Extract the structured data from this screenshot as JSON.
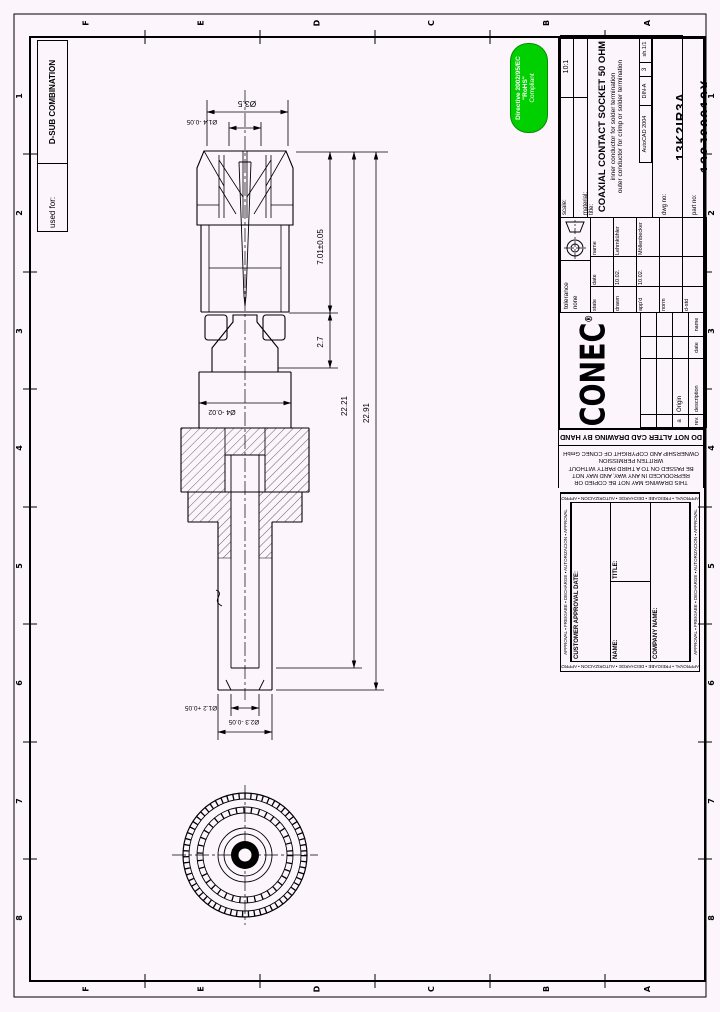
{
  "sheet": {
    "used_for_label": "used for:",
    "used_for_value": "D-SUB COMBINATION",
    "zone_letters": [
      "F",
      "E",
      "D",
      "C",
      "B",
      "A"
    ],
    "zone_numbers": [
      "1",
      "2",
      "3",
      "4",
      "5",
      "6",
      "7",
      "8"
    ],
    "line_color": "#000000",
    "paper_color": "#fdf5fc"
  },
  "rohs": {
    "line1": "Directive 2002/95/EC",
    "line2": "\"RoHS\"",
    "line3": "Compliant",
    "badge_color": "#00cf00"
  },
  "title_block": {
    "scale_label": "scale:",
    "scale_value": "10:1",
    "material_label": "material:",
    "material_value": "",
    "title_label": "title:",
    "title": "COAXIAL CONTACT SOCKET 50 OHM",
    "subtitle1": "inner conductor for solder termination",
    "subtitle2": "outer conductor for crimp or solder termination",
    "cad_system": "AutoCAD 2004",
    "format": "DIN-A",
    "format_size": "3",
    "sheet_no": "sh.1/1",
    "dwg_no_label": "dwg no:",
    "dwg_no": "13K2IR3A",
    "part_no_label": "part no:",
    "part_no": "132J20019X",
    "company": "CONEC",
    "registered_mark": "®",
    "tolerance_label": "tolerance",
    "tolerance_value": "none",
    "sign_table": {
      "headers": [
        "state",
        "date",
        "name"
      ],
      "rows": [
        {
          "label": "drawn",
          "date": "10.02.",
          "name": "Lehmkühler"
        },
        {
          "label": "app'd",
          "date": "10.02.",
          "name": "Möllenbecker"
        },
        {
          "label": "norm",
          "date": "",
          "name": ""
        },
        {
          "label": "d-std",
          "date": "",
          "name": ""
        }
      ]
    },
    "rev_table": {
      "headers": [
        "rev.",
        "description",
        "date",
        "name"
      ],
      "row": {
        "rev": "a",
        "description": "Origin",
        "date": "",
        "name": ""
      }
    }
  },
  "notices": {
    "copyright_lines": [
      "THIS DRAWING MAY NOT BE COPIED OR",
      "REPRODUCED IN ANY WAY, AND MAY NOT",
      "BE PASSED ON TO A THIRD PARTY WITHOUT",
      "WRITTEN PERMISSION",
      "OWNERSHIP AND COPYRIGHT OF CONEC GmbH"
    ],
    "do_not_alter": "DO NOT ALTER CAD DRAWING BY HAND"
  },
  "approval": {
    "border_text": "APPROVAL ▪ FREIGABE ▪ DECHARGE ▪ AUTORIZACION ▪ APPROVAL",
    "date_label": "CUSTOMER APPROVAL DATE:",
    "name_label": "NAME:",
    "title_label": "TITLE:",
    "company_label": "COMPANY NAME:"
  },
  "drawing": {
    "dims": {
      "dia_tip": "Ø1.4 -0.05",
      "dia_35": "Ø3.5",
      "len_701": "7.01±0.05",
      "len_27": "2.7",
      "dia_4": "Ø4 -0.02",
      "len_2221": "22.21",
      "len_2291": "22.91",
      "dia_12": "Ø1.2 +0.05",
      "dia_23": "Ø2.3 -0.05"
    }
  }
}
